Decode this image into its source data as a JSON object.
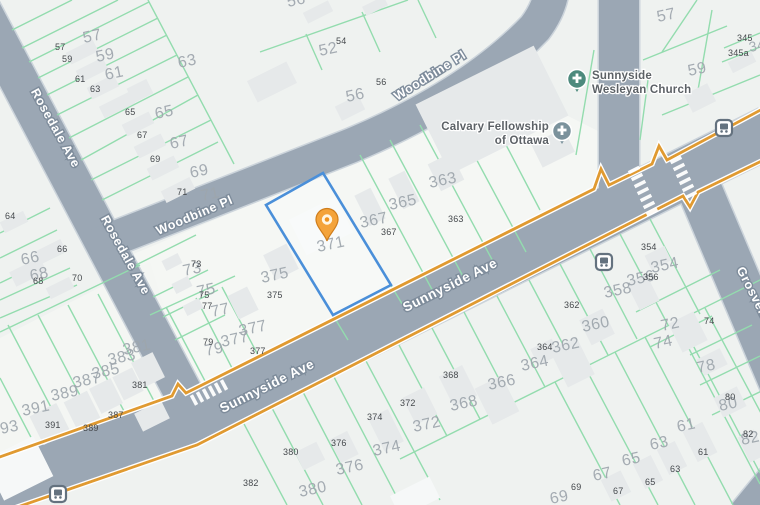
{
  "title": "Parcel map",
  "streets": {
    "rosedale": "Rosedale Ave",
    "woodbine": "Woodbine Pl",
    "sunnyside": "Sunnyside Ave",
    "grosvenor": "Grosvenor"
  },
  "pois": {
    "sunnyside_church": {
      "name_line1": "Sunnyside",
      "name_line2": "Wesleyan Church"
    },
    "calvary_church": {
      "name_line1": "Calvary Fellowship",
      "name_line2": "of Ottawa"
    }
  },
  "selected_parcel": {
    "label": "371",
    "outline_color": "#4a8fd9",
    "pin_color": "#f4a33a"
  },
  "labels": {
    "large": [
      "57",
      "59",
      "61",
      "63",
      "65",
      "67",
      "69",
      "71",
      "73",
      "75",
      "77",
      "79",
      "52",
      "56",
      "56",
      "57",
      "59",
      "345",
      "363",
      "365",
      "367",
      "371",
      "375",
      "377",
      "377",
      "381",
      "383",
      "385",
      "387",
      "389",
      "391",
      "393",
      "66",
      "68",
      "362",
      "364",
      "366",
      "368",
      "372",
      "374",
      "376",
      "380",
      "354",
      "356",
      "358",
      "360",
      "72",
      "74",
      "78",
      "80",
      "82",
      "61",
      "63",
      "65",
      "67",
      "69"
    ],
    "small": [
      "57",
      "59",
      "61",
      "63",
      "65",
      "67",
      "69",
      "71",
      "73",
      "75",
      "77",
      "79",
      "64",
      "66",
      "68",
      "70",
      "54",
      "56",
      "345",
      "345a",
      "363",
      "367",
      "375",
      "377",
      "381",
      "387",
      "389",
      "391",
      "382",
      "380",
      "376",
      "374",
      "372",
      "368",
      "364",
      "354",
      "356",
      "362",
      "74",
      "80",
      "82",
      "61",
      "63",
      "65",
      "67",
      "69"
    ]
  },
  "icons": {
    "pin": "location-pin-icon",
    "church": "church-icon",
    "bus": "bus-stop-icon"
  },
  "colors": {
    "land": "#eff2f0",
    "road": "#9ba7b4",
    "road_casing": "#ccd4db",
    "parcel_line": "#93dcae",
    "building": "#e6e9ea",
    "highlight": "#4a8fd9",
    "route": "#e09a31",
    "large_label": "#9ea6ad",
    "small_label": "#45494d",
    "church_teal": "#4d8a7d",
    "church_gray": "#7b929c"
  }
}
